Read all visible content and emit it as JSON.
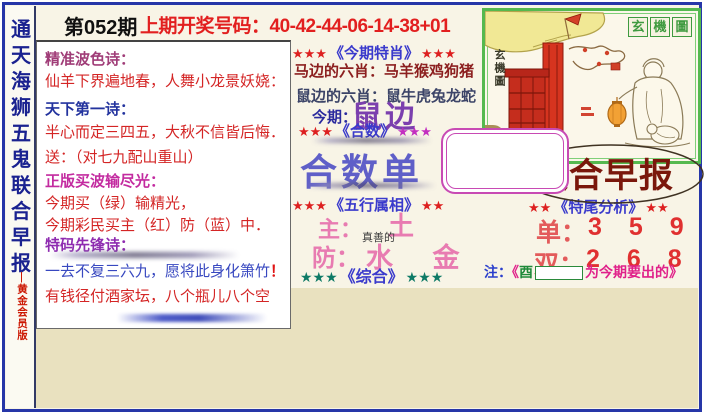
{
  "colors": {
    "frame_blue": "#2636a8",
    "paper_beige": "#e9e1bf",
    "accent_red": "#e21f1f",
    "accent_magenta": "#c84ab4",
    "masthead_red": "#7a170b",
    "title_blue": "#3a3acc",
    "pink": "#e87bb1",
    "purple": "#7b3fae",
    "green_border": "#55b94f"
  },
  "symbols": {
    "stars3": "★★★",
    "stars2": "★★"
  },
  "sidebar": {
    "chars": [
      "通",
      "天",
      "海",
      "狮",
      "五",
      "鬼",
      "联",
      "合",
      "早",
      "报"
    ],
    "edition": "—黄金会员版"
  },
  "header": {
    "issue": "第052期",
    "draw_label": "上期开奖号码：",
    "draw_numbers": "40-42-44-06-14-38+01"
  },
  "poem": {
    "exclaim": "！",
    "lines": [
      {
        "text": "精准波色诗："
      },
      {
        "text": "仙羊下界遍地春，人舞小龙景妖娆："
      },
      {
        "text": "天下第一诗："
      },
      {
        "text": "半心而定三四五，大秋不信皆后悔．"
      },
      {
        "text": "送：（对七九配山重山）"
      },
      {
        "text": "正版买波输尽光："
      },
      {
        "text": "今期买（绿）输精光，"
      },
      {
        "text": "今期彩民买主（红）防（蓝）中．"
      },
      {
        "text": "特码先锋诗："
      },
      {
        "text": "一去不复三六九，愿将此身化箫竹"
      },
      {
        "text": "有钱径付酒家坛，八个瓶儿八个空"
      }
    ]
  },
  "zodiac": {
    "title": "《今期特肖》",
    "horse_line": "马边的六肖：马羊猴鸡狗猪",
    "rat_line": "鼠边的六肖：鼠牛虎兔龙蛇",
    "current_label": "今期：",
    "current_value": "鼠边"
  },
  "hesu": {
    "title": "《合数》",
    "value": "合数单"
  },
  "wuxing": {
    "title": "《五行属相》",
    "main_label": "主：",
    "main_value": "土",
    "guard_label": "防：",
    "guard_value": "水 金",
    "watermark": "真善的"
  },
  "zonghe": {
    "title": "《综合》"
  },
  "mystery": {
    "label_chars": [
      "玄",
      "機",
      "圖"
    ],
    "side_label": "玄機圖"
  },
  "masthead": {
    "title": "联合早报"
  },
  "tail": {
    "title": "《特尾分析》",
    "odd_label": "单：",
    "odd_digits": "3 5 9",
    "even_label": "双：",
    "even_digits": "2 6 8"
  },
  "note": {
    "prefix": "注：",
    "open": "《",
    "zodiac_char": "酉",
    "suffix": "为今期要出的》"
  }
}
